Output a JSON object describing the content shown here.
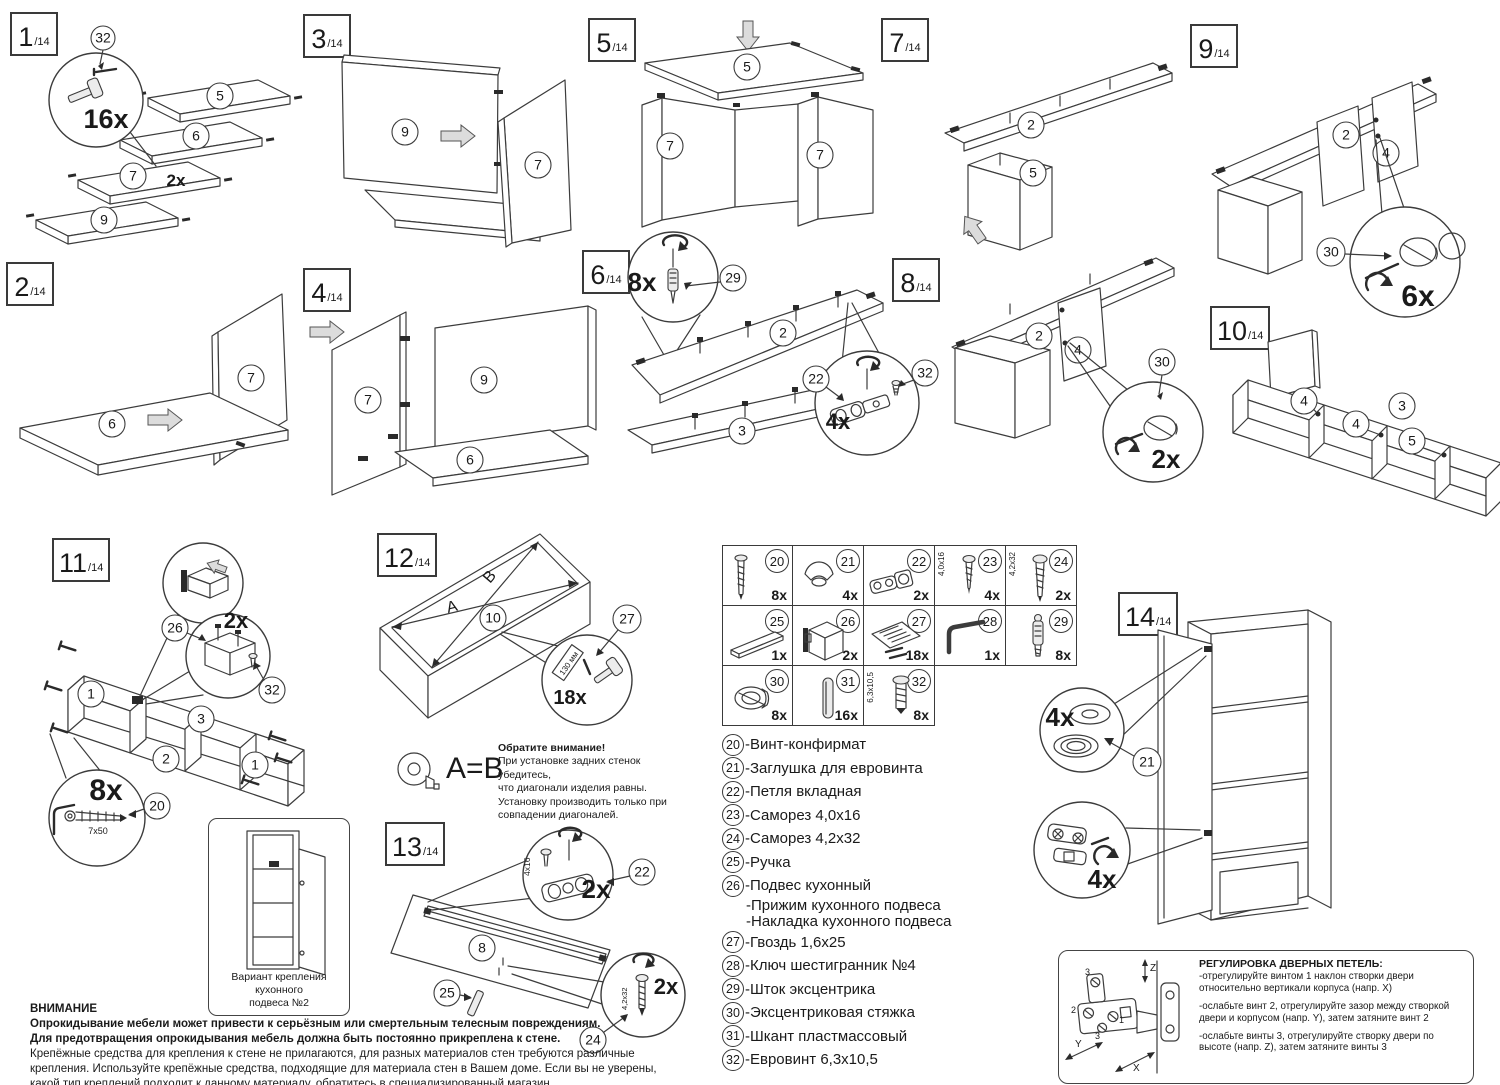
{
  "steps": {
    "s1": {
      "num": "1",
      "den": "/14",
      "parts": [
        "5",
        "6",
        "7",
        "9"
      ],
      "qty_hammer": "16x",
      "qty_panel": "2x",
      "co32": "32"
    },
    "s2": {
      "num": "2",
      "den": "/14",
      "parts": [
        "6",
        "7"
      ]
    },
    "s3": {
      "num": "3",
      "den": "/14",
      "parts": [
        "9",
        "7"
      ]
    },
    "s4": {
      "num": "4",
      "den": "/14",
      "parts": [
        "7",
        "9",
        "6"
      ]
    },
    "s5": {
      "num": "5",
      "den": "/14",
      "parts": [
        "5",
        "7",
        "7"
      ]
    },
    "s6": {
      "num": "6",
      "den": "/14",
      "parts": [
        "2",
        "3"
      ],
      "qty_rod": "8x",
      "co29": "29",
      "qty_hinge": "4x",
      "co22": "22",
      "co32": "32"
    },
    "s7": {
      "num": "7",
      "den": "/14",
      "parts": [
        "2",
        "5"
      ]
    },
    "s8": {
      "num": "8",
      "den": "/14",
      "parts": [
        "2",
        "4"
      ],
      "qty_cam": "2x",
      "co30": "30"
    },
    "s9": {
      "num": "9",
      "den": "/14",
      "parts": [
        "2",
        "4"
      ],
      "qty_cam": "6x",
      "co30": "30"
    },
    "s10": {
      "num": "10",
      "den": "/14",
      "parts": [
        "4",
        "4",
        "3",
        "5"
      ]
    },
    "s11": {
      "num": "11",
      "den": "/14",
      "parts": [
        "1",
        "3",
        "2",
        "1"
      ],
      "qty_bracket": "2x",
      "co26": "26",
      "co32": "32",
      "qty_screw": "8x",
      "screw_size": "7x50",
      "co20": "20"
    },
    "s12": {
      "num": "12",
      "den": "/14",
      "part": "10",
      "diag_a": "A",
      "diag_b": "B",
      "qty_nail": "18x",
      "co27": "27",
      "spacing": "130 мм"
    },
    "s13": {
      "num": "13",
      "den": "/14",
      "part": "8",
      "qty_hinge": "2x",
      "hinge_screw_size": "4x16",
      "co22": "22",
      "co25": "25",
      "qty_screw": "2x",
      "screw_size": "4,2x32",
      "co24": "24"
    },
    "s14": {
      "num": "14",
      "den": "/14",
      "qty_cap": "4x",
      "co21": "21",
      "qty_hinge": "4x"
    }
  },
  "parts_table": {
    "cells": [
      {
        "num": "20",
        "qty": "8x",
        "size": "",
        "icon": "confirmat-screw"
      },
      {
        "num": "21",
        "qty": "4x",
        "size": "",
        "icon": "euro-cap"
      },
      {
        "num": "22",
        "qty": "2x",
        "size": "",
        "icon": "hinge"
      },
      {
        "num": "23",
        "qty": "4x",
        "size": "4,0x16",
        "icon": "screw"
      },
      {
        "num": "24",
        "qty": "2x",
        "size": "4,2x32",
        "icon": "screw"
      },
      {
        "num": "25",
        "qty": "1x",
        "size": "",
        "icon": "handle"
      },
      {
        "num": "26",
        "qty": "2x",
        "size": "",
        "icon": "hanger-bracket"
      },
      {
        "num": "27",
        "qty": "18x",
        "size": "",
        "icon": "nails-pack"
      },
      {
        "num": "28",
        "qty": "1x",
        "size": "",
        "icon": "hex-key"
      },
      {
        "num": "29",
        "qty": "8x",
        "size": "",
        "icon": "cam-rod"
      },
      {
        "num": "30",
        "qty": "8x",
        "size": "",
        "icon": "cam-lock"
      },
      {
        "num": "31",
        "qty": "16x",
        "size": "",
        "icon": "dowel"
      },
      {
        "num": "32",
        "qty": "8x",
        "size": "6,3x10,5",
        "icon": "euro-screw"
      }
    ]
  },
  "legend": {
    "items": [
      {
        "num": "20",
        "text": "-Винт-конфирмат"
      },
      {
        "num": "21",
        "text": "-Заглушка для евровинта"
      },
      {
        "num": "22",
        "text": "-Петля вкладная"
      },
      {
        "num": "23",
        "text": "-Саморез 4,0х16"
      },
      {
        "num": "24",
        "text": "-Саморез 4,2х32"
      },
      {
        "num": "25",
        "text": "-Ручка"
      },
      {
        "num": "26",
        "text": "-Подвес кухонный",
        "text2": "-Прижим кухонного подвеса",
        "text3": "-Накладка кухонного подвеса"
      },
      {
        "num": "27",
        "text": "-Гвоздь 1,6х25"
      },
      {
        "num": "28",
        "text": "-Ключ шестигранник №4"
      },
      {
        "num": "29",
        "text": "-Шток эксцентрика"
      },
      {
        "num": "30",
        "text": "-Эксцентриковая стяжка"
      },
      {
        "num": "31",
        "text": "-Шкант пластмассовый"
      },
      {
        "num": "32",
        "text": "-Евровинт 6,3х10,5"
      }
    ]
  },
  "note": {
    "ab": "A=B",
    "title": "Обратите внимание!",
    "lines": [
      "При установке задних стенок убедитесь,",
      "что диагонали изделия равны.",
      "Установку производить только при",
      "совпадении диагоналей."
    ]
  },
  "variant": {
    "cap1": "Вариант крепления кухонного",
    "cap2": "подвеса №2"
  },
  "warning": {
    "title": "ВНИМАНИЕ",
    "bold1": "Опрокидывание мебели может привести к серьёзным или смертельным телесным повреждениям.",
    "bold2": "Для предотвращения опрокидывания мебель должна быть постоянно прикреплена к стене.",
    "body": "Крепёжные средства для крепления к стене не прилагаются, для разных материалов стен требуются различные крепления. Используйте крепёжные средства, подходящие для материала стен в Вашем доме. Если вы не уверены, какой тип креплений подходит к данному материалу, обратитесь в специализированный магазин."
  },
  "hinge_adjustment": {
    "title": "РЕГУЛИРОВКА ДВЕРНЫХ ПЕТЕЛЬ:",
    "items": [
      "-отрегулируйте винтом 1 наклон створки двери относительно вертикали корпуса (напр. X)",
      "-ослабьте винт 2, отрегулируйте зазор между створкой двери и корпусом (напр. Y), затем затяните винт 2",
      "-ослабьте винты 3, отрегулируйте створку двери по высоте (напр. Z), затем затяните винты 3"
    ],
    "labels": {
      "x": "X",
      "y": "Y",
      "z": "Z",
      "n1": "1",
      "n2": "2",
      "n3": "3"
    }
  }
}
